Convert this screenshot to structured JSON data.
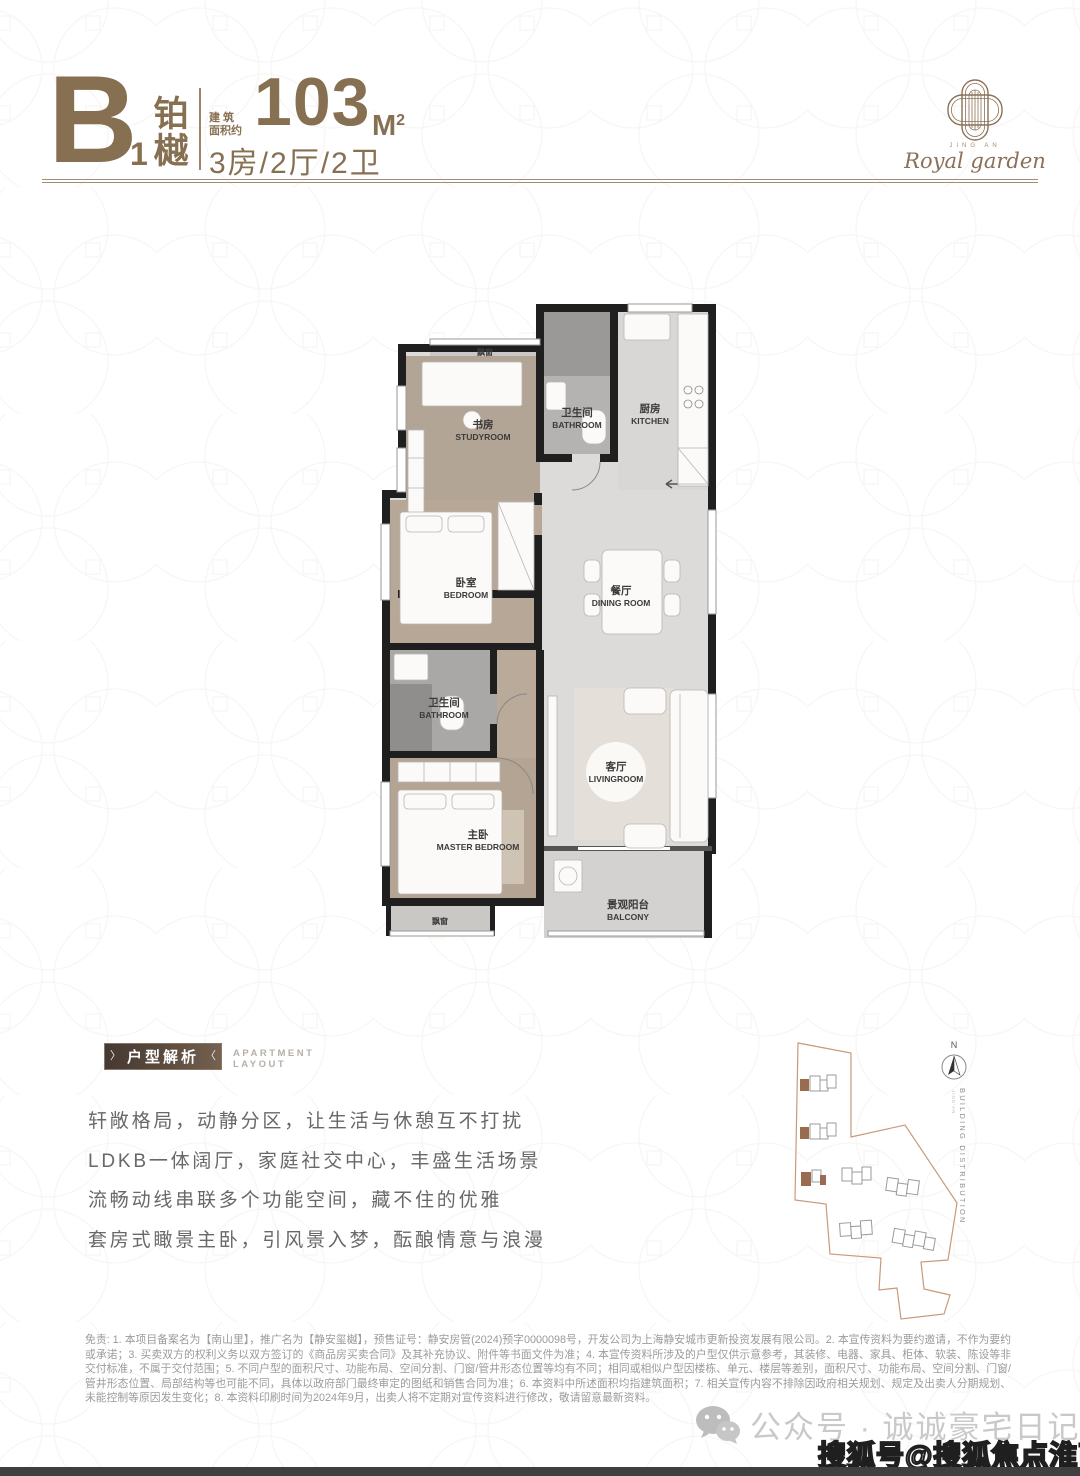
{
  "header": {
    "unit_letter": "B",
    "unit_number": "1",
    "unit_name": "铂樾",
    "unit_name_chars": [
      "铂",
      "樾"
    ],
    "area_label_line1": "建 筑",
    "area_label_line2": "面积约",
    "area_value": "103",
    "area_unit": "M",
    "area_unit_sup": "2",
    "layout_spec": "3房/2厅/2卫"
  },
  "logo": {
    "brand_small": "JING AN",
    "brand_script": "Royal garden"
  },
  "floorplan": {
    "bay_window_top": "飘窗",
    "bay_window_bottom": "飘窗",
    "rooms": [
      {
        "cn": "书房",
        "en": "STUDYROOM"
      },
      {
        "cn": "卫生间",
        "en": "BATHROOM"
      },
      {
        "cn": "厨房",
        "en": "KITCHEN"
      },
      {
        "cn": "卧室",
        "en": "BEDROOM"
      },
      {
        "cn": "餐厅",
        "en": "DINING ROOM"
      },
      {
        "cn": "卫生间",
        "en": "BATHROOM"
      },
      {
        "cn": "主卧",
        "en": "MASTER BEDROOM"
      },
      {
        "cn": "客厅",
        "en": "LIVINGROOM"
      },
      {
        "cn": "景观阳台",
        "en": "BALCONY"
      }
    ]
  },
  "analysis": {
    "title": "户型解析",
    "subtitle_line1": "APARTMENT",
    "subtitle_line2": "LAYOUT",
    "lines": [
      "轩敞格局，动静分区，让生活与休憩互不打扰",
      "LDKB一体阔厅，家庭社交中心，丰盛生活场景",
      "流畅动线串联多个功能空间，藏不住的优雅",
      "套房式瞰景主卧，引风景入梦，酝酿情意与浪漫"
    ]
  },
  "sitemap": {
    "compass": "N",
    "caption": "BUILDING DISTRIBUTION",
    "caption_small": "JING'AN"
  },
  "disclaimer": "免责: 1. 本项目备案名为【南山里】，推广名为【静安玺樾】，预售证号：静安房管(2024)预字0000098号，开发公司为上海静安城市更新投资发展有限公司。2. 本宣传资料为要约邀请，不作为要约或承诺；3. 买卖双方的权利义务以双方签订的《商品房买卖合同》及其补充协议、附件等书面文件为准；4. 本宣传资料所涉及的户型仅供示意参考，其装修、电器、家具、柜体、软装、陈设等非交付标准，不属于交付范围；5. 不同户型的面积尺寸、功能布局、空间分割、门窗/管井形态位置等均有不同；相同或相似户型因楼栋、单元、楼层等差别，面积尺寸、功能布局、空间分割、门窗/管井形态位置、局部结构等也可能不同，具体以政府部门最终审定的图纸和销售合同为准；6. 本资料中所述面积均指建筑面积；7. 相关宣传内容不排除因政府相关规划、规定及出卖人分期规划、未能控制等原因发生变化；8. 本资料印刷时间为2024年9月，出卖人将不定期对宣传资料进行修改，敬请留意最新资料。",
  "watermarks": {
    "wechat_account": "公众号 · 诚诚豪宅日记",
    "sohu_account": "搜狐号@搜狐焦点淮南站"
  },
  "colors": {
    "brand_brown": "#877052",
    "rule_line": "#a38c6f",
    "title_box_dark": "#453931",
    "title_box_light": "#75614f",
    "wall_black": "#1f1f1f",
    "wood_floor": "#b3a595",
    "marble_floor": "#dcdbd9",
    "map_boundary": "#c89a7a",
    "map_highlight": "#996b50"
  }
}
